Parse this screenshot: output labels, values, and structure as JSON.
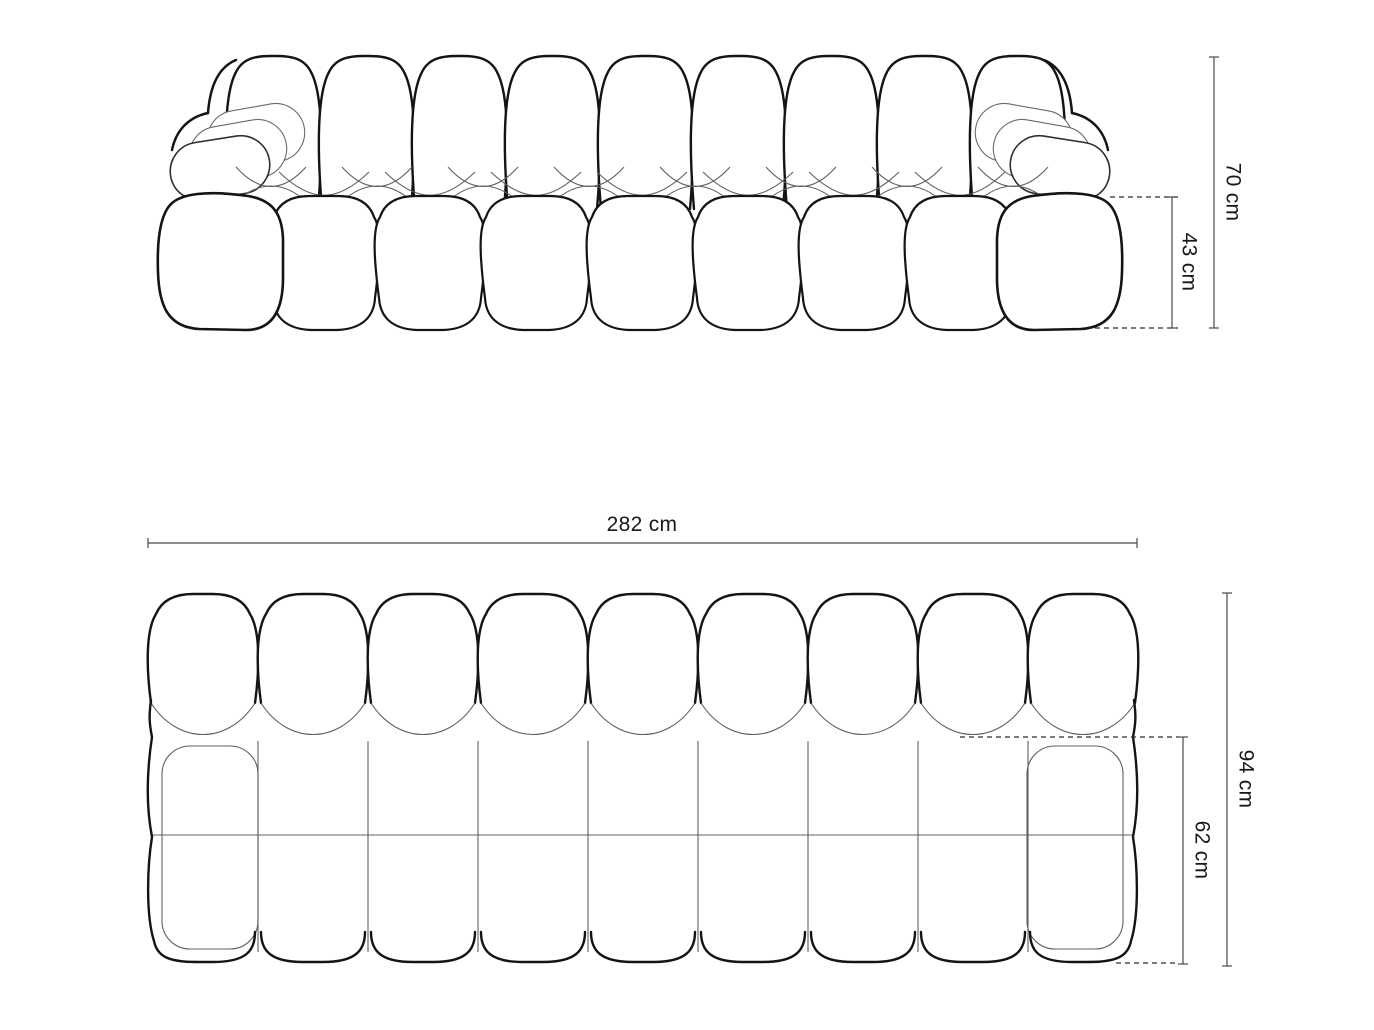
{
  "diagram": {
    "type": "technical-dimension-drawing",
    "subject": "modular bubble sofa shown as front elevation (top) and plan view (bottom)",
    "background": "#ffffff",
    "line_colors": {
      "outline_bold": "#141414",
      "seam_thin": "#606060",
      "dimension_line": "#4a4a4a",
      "dashed_extension": "#2f2f2f",
      "text": "#181818"
    },
    "front_elevation": {
      "back_cushions": 9,
      "seat_cushions": 7,
      "armrests": 2,
      "dimensions": [
        {
          "label": "70 cm",
          "value_cm": 70,
          "orientation": "vertical",
          "measures": "overall height"
        },
        {
          "label": "43 cm",
          "value_cm": 43,
          "orientation": "vertical",
          "measures": "seat / armrest height"
        }
      ]
    },
    "plan_view": {
      "modules_wide": 9,
      "rows_deep": 3,
      "dimensions": [
        {
          "label": "282 cm",
          "value_cm": 282,
          "orientation": "horizontal",
          "measures": "overall width"
        },
        {
          "label": "94 cm",
          "value_cm": 94,
          "orientation": "vertical",
          "measures": "overall depth"
        },
        {
          "label": "62 cm",
          "value_cm": 62,
          "orientation": "vertical",
          "measures": "seat depth"
        }
      ]
    }
  },
  "labels": {
    "overall_height": "70 cm",
    "seat_height": "43 cm",
    "overall_width": "282 cm",
    "overall_depth": "94 cm",
    "seat_depth": "62 cm"
  }
}
